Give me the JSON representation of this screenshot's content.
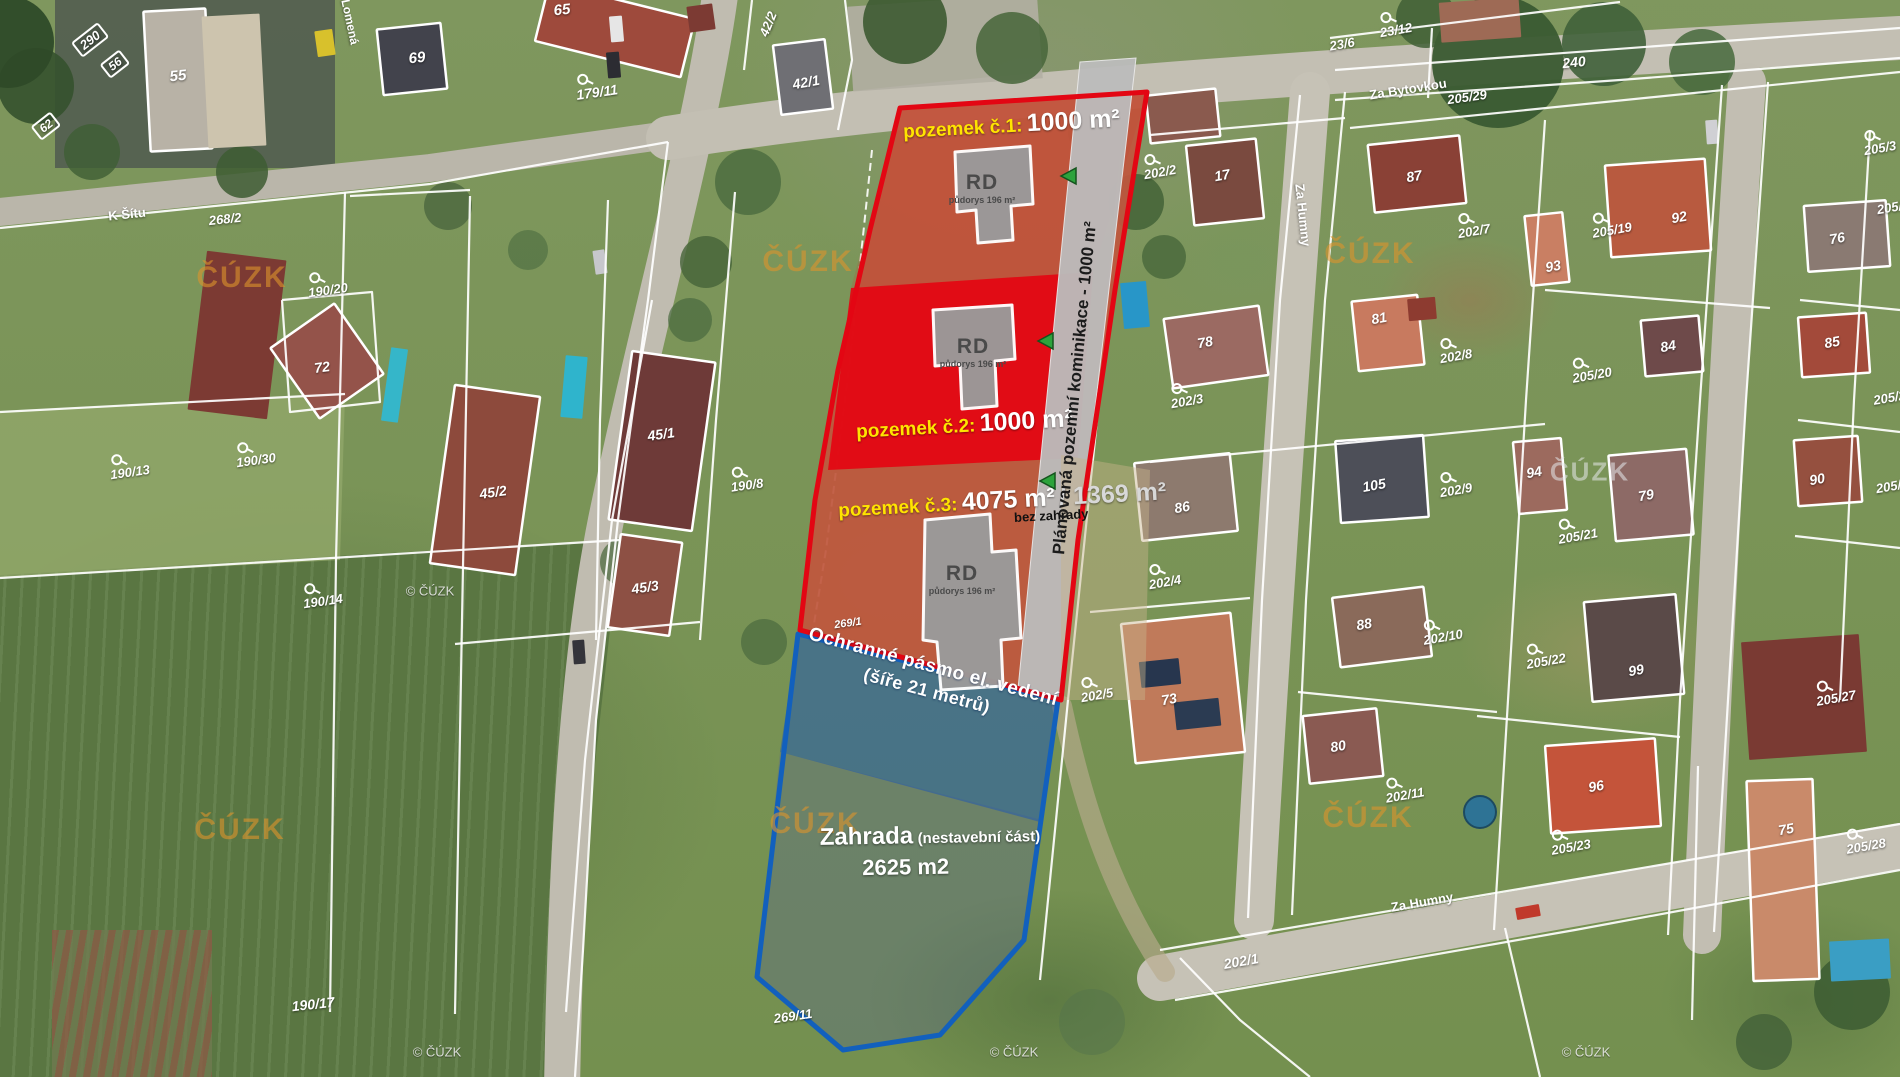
{
  "plots": {
    "p1": {
      "label": "pozemek č.1:",
      "value": "1000 m²"
    },
    "p2": {
      "label": "pozemek č.2:",
      "value": "1000 m²"
    },
    "p3": {
      "label": "pozemek č.3:",
      "value": "4075 m²",
      "value_alt": "/ 1369 m²",
      "note": "bez zahrady"
    }
  },
  "road_overlay": {
    "text": "Plánovaná pozemní kominikace - 1000 m²"
  },
  "protection_zone": {
    "line1": "Ochranné pásmo el. vedení",
    "line2": "(šíře 21 metrů)"
  },
  "garden": {
    "title": "Zahrada",
    "qualifier": "(nestavební část)",
    "area": "2625 m2"
  },
  "rd": {
    "label": "RD",
    "sub": "půdorys 196 m²"
  },
  "colors": {
    "plot_outline": "#e30613",
    "garden_outline": "#1260bd",
    "highlight_yellow": "#ffe400",
    "arrow_green": "#2da33c",
    "watermark_orange": "#de942c"
  },
  "watermark_items": [
    {
      "t": "ČÚZK",
      "x": 242,
      "y": 278,
      "k": "orange"
    },
    {
      "t": "ČÚZK",
      "x": 808,
      "y": 262,
      "k": "orange"
    },
    {
      "t": "ČÚZK",
      "x": 1370,
      "y": 254,
      "k": "orange"
    },
    {
      "t": "ČÚZK",
      "x": 240,
      "y": 830,
      "k": "orange"
    },
    {
      "t": "ČÚZK",
      "x": 815,
      "y": 824,
      "k": "orange"
    },
    {
      "t": "ČÚZK",
      "x": 1368,
      "y": 818,
      "k": "orange"
    },
    {
      "t": "ČÚZK",
      "x": 1590,
      "y": 472,
      "k": "gray"
    },
    {
      "t": "© ČÚZK",
      "x": 430,
      "y": 591,
      "k": "small"
    },
    {
      "t": "© ČÚZK",
      "x": 437,
      "y": 1052,
      "k": "small"
    },
    {
      "t": "© ČÚZK",
      "x": 1014,
      "y": 1052,
      "k": "small"
    },
    {
      "t": "© ČÚZK",
      "x": 1586,
      "y": 1052,
      "k": "small"
    }
  ],
  "street_labels": [
    {
      "t": "K Šítu",
      "x": 127,
      "y": 214,
      "r": -6,
      "s": 13
    },
    {
      "t": "Za Bytovkou",
      "x": 1408,
      "y": 89,
      "r": -9,
      "s": 13
    },
    {
      "t": "Za Humny",
      "x": 1303,
      "y": 215,
      "r": 84,
      "s": 13
    },
    {
      "t": "Za Humny",
      "x": 1422,
      "y": 902,
      "r": -10,
      "s": 13
    },
    {
      "t": "Lomená",
      "x": 350,
      "y": 22,
      "r": 78,
      "s": 12
    }
  ],
  "parcel_labels": [
    {
      "t": "290",
      "x": 90,
      "y": 40,
      "r": -38,
      "s": 13,
      "box": true
    },
    {
      "t": "56",
      "x": 115,
      "y": 64,
      "r": -38,
      "s": 12,
      "box": true
    },
    {
      "t": "62",
      "x": 46,
      "y": 126,
      "r": -38,
      "s": 12,
      "box": true
    },
    {
      "t": "55",
      "x": 178,
      "y": 76,
      "r": -6,
      "s": 15
    },
    {
      "t": "69",
      "x": 417,
      "y": 58,
      "r": -6,
      "s": 15
    },
    {
      "t": "65",
      "x": 562,
      "y": 10,
      "r": -6,
      "s": 15
    },
    {
      "t": "179/11",
      "x": 597,
      "y": 92,
      "r": -8,
      "s": 14,
      "sym": true
    },
    {
      "t": "42/2",
      "x": 768,
      "y": 24,
      "r": -68,
      "s": 13
    },
    {
      "t": "42/1",
      "x": 806,
      "y": 82,
      "r": -10,
      "s": 14
    },
    {
      "t": "23/12",
      "x": 1396,
      "y": 30,
      "r": -10,
      "s": 13,
      "sym": true
    },
    {
      "t": "23/6",
      "x": 1342,
      "y": 44,
      "r": -10,
      "s": 13
    },
    {
      "t": "240",
      "x": 1574,
      "y": 62,
      "r": -6,
      "s": 14
    },
    {
      "t": "205/29",
      "x": 1467,
      "y": 97,
      "r": -8,
      "s": 13
    },
    {
      "t": "202/2",
      "x": 1160,
      "y": 172,
      "r": -10,
      "s": 13,
      "sym": true
    },
    {
      "t": "17",
      "x": 1222,
      "y": 175,
      "r": -10,
      "s": 14
    },
    {
      "t": "87",
      "x": 1414,
      "y": 176,
      "r": -10,
      "s": 14
    },
    {
      "t": "202/7",
      "x": 1474,
      "y": 231,
      "r": -10,
      "s": 13,
      "sym": true
    },
    {
      "t": "93",
      "x": 1553,
      "y": 266,
      "r": -10,
      "s": 14
    },
    {
      "t": "205/19",
      "x": 1612,
      "y": 230,
      "r": -10,
      "s": 13,
      "sym": true
    },
    {
      "t": "92",
      "x": 1679,
      "y": 217,
      "r": -10,
      "s": 14
    },
    {
      "t": "205/3",
      "x": 1880,
      "y": 148,
      "r": -10,
      "s": 13,
      "sym": true
    },
    {
      "t": "81",
      "x": 1379,
      "y": 318,
      "r": -10,
      "s": 14
    },
    {
      "t": "202/8",
      "x": 1456,
      "y": 356,
      "r": -10,
      "s": 13,
      "sym": true
    },
    {
      "t": "78",
      "x": 1205,
      "y": 342,
      "r": -10,
      "s": 14
    },
    {
      "t": "202/3",
      "x": 1187,
      "y": 401,
      "r": -10,
      "s": 13,
      "sym": true
    },
    {
      "t": "76",
      "x": 1837,
      "y": 238,
      "r": -10,
      "s": 14
    },
    {
      "t": "205/20",
      "x": 1592,
      "y": 375,
      "r": -10,
      "s": 13,
      "sym": true
    },
    {
      "t": "85",
      "x": 1832,
      "y": 342,
      "r": -10,
      "s": 14
    },
    {
      "t": "84",
      "x": 1668,
      "y": 346,
      "r": -10,
      "s": 14
    },
    {
      "t": "86",
      "x": 1182,
      "y": 507,
      "r": -10,
      "s": 14
    },
    {
      "t": "105",
      "x": 1374,
      "y": 485,
      "r": -10,
      "s": 14
    },
    {
      "t": "202/9",
      "x": 1456,
      "y": 490,
      "r": -10,
      "s": 13,
      "sym": true
    },
    {
      "t": "94",
      "x": 1534,
      "y": 472,
      "r": -10,
      "s": 14
    },
    {
      "t": "79",
      "x": 1646,
      "y": 495,
      "r": -10,
      "s": 14
    },
    {
      "t": "205/21",
      "x": 1578,
      "y": 536,
      "r": -10,
      "s": 13,
      "sym": true
    },
    {
      "t": "90",
      "x": 1817,
      "y": 479,
      "r": -10,
      "s": 14
    },
    {
      "t": "202/4",
      "x": 1165,
      "y": 582,
      "r": -10,
      "s": 13,
      "sym": true
    },
    {
      "t": "202/5",
      "x": 1097,
      "y": 695,
      "r": -10,
      "s": 13,
      "sym": true
    },
    {
      "t": "73",
      "x": 1169,
      "y": 699,
      "r": -10,
      "s": 14
    },
    {
      "t": "88",
      "x": 1364,
      "y": 624,
      "r": -10,
      "s": 14
    },
    {
      "t": "202/10",
      "x": 1443,
      "y": 637,
      "r": -10,
      "s": 13,
      "sym": true
    },
    {
      "t": "80",
      "x": 1338,
      "y": 746,
      "r": -10,
      "s": 14
    },
    {
      "t": "202/11",
      "x": 1405,
      "y": 795,
      "r": -10,
      "s": 13,
      "sym": true
    },
    {
      "t": "99",
      "x": 1636,
      "y": 670,
      "r": -10,
      "s": 14
    },
    {
      "t": "205/22",
      "x": 1546,
      "y": 661,
      "r": -10,
      "s": 13,
      "sym": true
    },
    {
      "t": "205/27",
      "x": 1836,
      "y": 698,
      "r": -10,
      "s": 13,
      "sym": true
    },
    {
      "t": "96",
      "x": 1596,
      "y": 786,
      "r": -10,
      "s": 14
    },
    {
      "t": "205/23",
      "x": 1571,
      "y": 847,
      "r": -10,
      "s": 13,
      "sym": true
    },
    {
      "t": "75",
      "x": 1786,
      "y": 829,
      "r": -10,
      "s": 14
    },
    {
      "t": "205/28",
      "x": 1866,
      "y": 846,
      "r": -10,
      "s": 13,
      "sym": true
    },
    {
      "t": "202/1",
      "x": 1241,
      "y": 961,
      "r": -10,
      "s": 14
    },
    {
      "t": "190/17",
      "x": 313,
      "y": 1004,
      "r": -6,
      "s": 14
    },
    {
      "t": "269/11",
      "x": 793,
      "y": 1016,
      "r": -8,
      "s": 13
    },
    {
      "t": "269/1",
      "x": 848,
      "y": 624,
      "r": -8,
      "s": 11
    },
    {
      "t": "190/20",
      "x": 328,
      "y": 290,
      "r": -8,
      "s": 13,
      "sym": true
    },
    {
      "t": "72",
      "x": 322,
      "y": 367,
      "r": -8,
      "s": 14
    },
    {
      "t": "190/30",
      "x": 256,
      "y": 460,
      "r": -8,
      "s": 13,
      "sym": true
    },
    {
      "t": "190/13",
      "x": 130,
      "y": 472,
      "r": -8,
      "s": 13,
      "sym": true
    },
    {
      "t": "45/1",
      "x": 661,
      "y": 434,
      "r": -8,
      "s": 14
    },
    {
      "t": "45/2",
      "x": 493,
      "y": 492,
      "r": -8,
      "s": 14
    },
    {
      "t": "190/8",
      "x": 747,
      "y": 485,
      "r": -8,
      "s": 13,
      "sym": true
    },
    {
      "t": "45/3",
      "x": 645,
      "y": 587,
      "r": -8,
      "s": 14
    },
    {
      "t": "190/14",
      "x": 323,
      "y": 601,
      "r": -8,
      "s": 13,
      "sym": true
    },
    {
      "t": "268/2",
      "x": 225,
      "y": 219,
      "r": -6,
      "s": 13
    },
    {
      "t": "205/4",
      "x": 1893,
      "y": 207,
      "r": -10,
      "s": 13
    },
    {
      "t": "205/24",
      "x": 1893,
      "y": 397,
      "r": -10,
      "s": 13
    },
    {
      "t": "205/2",
      "x": 1892,
      "y": 486,
      "r": -10,
      "s": 13
    }
  ]
}
